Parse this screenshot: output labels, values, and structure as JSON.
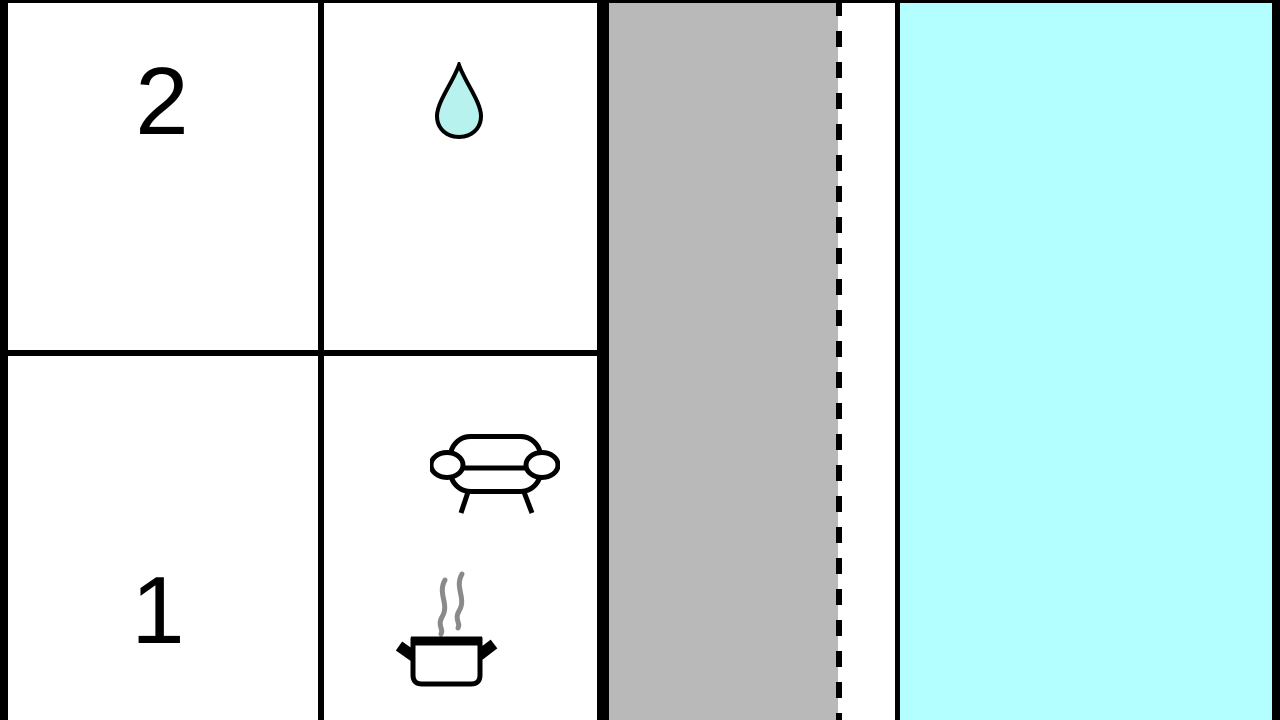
{
  "plan": {
    "type": "floor-plan",
    "rooms": [
      {
        "id": "room-2",
        "label": "2",
        "icon": "water-drop-icon"
      },
      {
        "id": "room-1",
        "label": "1",
        "icons": [
          "sofa-icon",
          "cooking-pot-icon",
          "steam-icon"
        ]
      }
    ],
    "areas": [
      {
        "name": "terrace-strip",
        "color": "#b9b9b9"
      },
      {
        "name": "pool-area",
        "color": "#b3ffff"
      }
    ],
    "lines": [
      {
        "name": "boundary-dashed-line",
        "style": "dashed",
        "color": "#000000"
      },
      {
        "name": "pool-edge-line",
        "style": "solid",
        "color": "#000000"
      }
    ]
  },
  "colors": {
    "terrace": "#b9b9b9",
    "pool": "#b3ffff",
    "drop": "#b7f2ef",
    "steam": "#8a8a8a",
    "wall": "#000000"
  }
}
